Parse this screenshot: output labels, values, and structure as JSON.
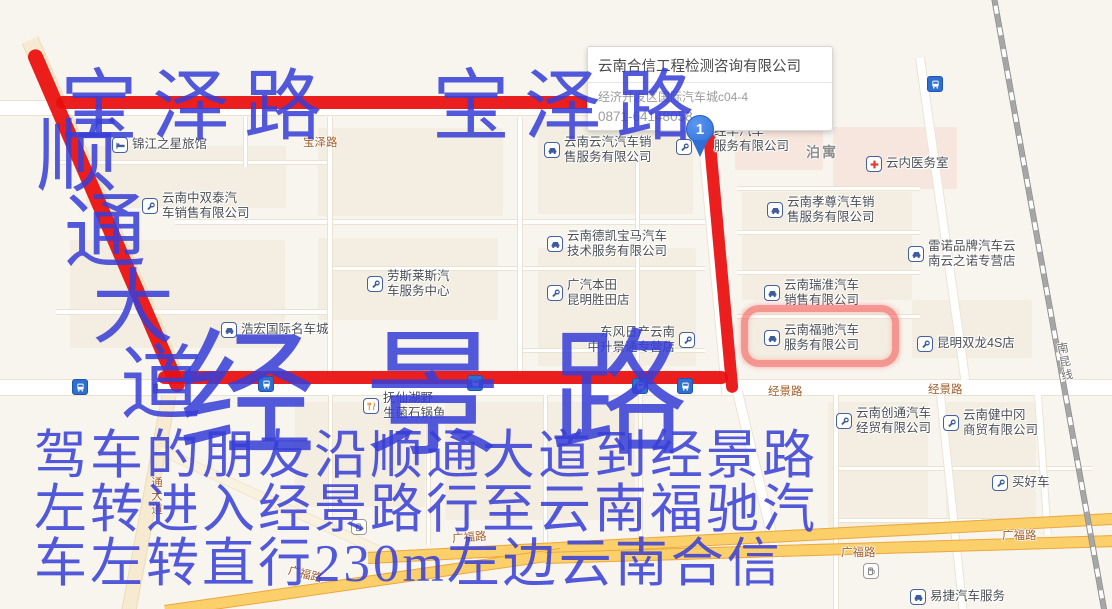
{
  "popup": {
    "title": "云南合信工程检测咨询有限公司",
    "address": "经济开发区国际汽车城c04-4",
    "phone": "0871-64148058"
  },
  "marker": {
    "label": "1"
  },
  "pois": [
    {
      "icon": "hotel",
      "x": 112,
      "y": 137,
      "lines": [
        "锦江之星旅馆"
      ]
    },
    {
      "icon": "wrench",
      "x": 142,
      "y": 198,
      "lines": [
        "云南中双泰汽",
        "车销售有限公司"
      ]
    },
    {
      "icon": "wrench",
      "x": 367,
      "y": 276,
      "lines": [
        "劳斯莱斯汽",
        "车服务中心"
      ]
    },
    {
      "icon": "car",
      "x": 221,
      "y": 322,
      "lines": [
        "浩宏国际名车城"
      ]
    },
    {
      "icon": "car",
      "x": 544,
      "y": 142,
      "lines": [
        "云南云汽汽车销",
        "售服务有限公司"
      ]
    },
    {
      "icon": "car",
      "x": 547,
      "y": 236,
      "lines": [
        "云南德凯宝马汽车",
        "技术服务有限公司"
      ]
    },
    {
      "icon": "wrench",
      "x": 547,
      "y": 285,
      "lines": [
        "广汽本田",
        "昆明胜田店"
      ]
    },
    {
      "icon": "wrench",
      "x": 679,
      "y": 332,
      "side": "right",
      "lines": [
        "东风日产云南",
        "中升景通专营店"
      ]
    },
    {
      "icon": null,
      "x": 714,
      "y": 131,
      "lines": [
        "经华汽车",
        "服务有限公司"
      ]
    },
    {
      "icon": "wrench",
      "x": 676,
      "y": 139,
      "lines": []
    },
    {
      "icon": "cross",
      "x": 866,
      "y": 156,
      "lines": [
        "云内医务室"
      ]
    },
    {
      "icon": "car",
      "x": 767,
      "y": 202,
      "lines": [
        "云南孝尊汽车销",
        "售服务有限公司"
      ]
    },
    {
      "icon": "car",
      "x": 908,
      "y": 246,
      "lines": [
        "雷诺品牌汽车云",
        "南云之诺专营店"
      ]
    },
    {
      "icon": "car",
      "x": 764,
      "y": 285,
      "lines": [
        "云南瑞淮汽车",
        "销售有限公司"
      ]
    },
    {
      "icon": "car",
      "x": 764,
      "y": 330,
      "lines": [
        "云南福驰汽车",
        "服务有限公司"
      ]
    },
    {
      "icon": "wrench",
      "x": 917,
      "y": 336,
      "lines": [
        "昆明双龙4S店"
      ]
    },
    {
      "icon": "restaurant",
      "x": 363,
      "y": 398,
      "lines": [
        "抚仙湖野",
        "生菌石锅鱼"
      ]
    },
    {
      "icon": "wrench",
      "x": 836,
      "y": 413,
      "lines": [
        "云南创通汽车",
        "经贸有限公司"
      ]
    },
    {
      "icon": "wrench",
      "x": 943,
      "y": 415,
      "lines": [
        "云南健中冈",
        "商贸有限公司"
      ]
    },
    {
      "icon": "wrench",
      "x": 992,
      "y": 475,
      "lines": [
        "买好车"
      ]
    },
    {
      "icon": "car",
      "x": 910,
      "y": 589,
      "lines": [
        "易捷汽车服务"
      ]
    }
  ],
  "area_labels": [
    {
      "text": "泊寓",
      "x": 806,
      "y": 142
    }
  ],
  "map_icons": [
    {
      "type": "bus",
      "x": 927,
      "y": 76
    },
    {
      "type": "bus",
      "x": 72,
      "y": 379
    },
    {
      "type": "bus",
      "x": 258,
      "y": 376
    },
    {
      "type": "bus",
      "x": 467,
      "y": 375
    },
    {
      "type": "bus",
      "x": 632,
      "y": 378
    },
    {
      "type": "bus",
      "x": 677,
      "y": 378
    },
    {
      "type": "gas",
      "x": 351,
      "y": 519
    },
    {
      "type": "gas",
      "x": 863,
      "y": 563
    },
    {
      "type": "traffic-light",
      "x": 149,
      "y": 378
    }
  ],
  "road_labels": [
    {
      "text": "宝泽路",
      "x": 303,
      "y": 134
    },
    {
      "text": "经景路",
      "x": 768,
      "y": 383
    },
    {
      "text": "经景路",
      "x": 928,
      "y": 381
    },
    {
      "text": "广福路",
      "x": 288,
      "y": 566,
      "rot": 14
    },
    {
      "text": "广福路",
      "x": 452,
      "y": 529,
      "rot": -4
    },
    {
      "text": "广福路",
      "x": 841,
      "y": 544
    },
    {
      "text": "广福路",
      "x": 1002,
      "y": 527
    },
    {
      "text": "通大道",
      "x": 148,
      "y": 476,
      "vert": true
    },
    {
      "text": "南昆线",
      "x": 1056,
      "y": 342,
      "vert": true,
      "rot": -9,
      "color": "#6b6b6b"
    }
  ],
  "annotations": {
    "color": "rgba(55,62,214,0.86)",
    "texts": [
      {
        "text": "宝泽路",
        "x": 60,
        "y": 68,
        "size": 78,
        "ls": 14
      },
      {
        "text": "宝泽路",
        "x": 432,
        "y": 68,
        "size": 78,
        "ls": 14
      },
      {
        "text": "顺通大道",
        "x": 36,
        "y": 116,
        "size": 82,
        "stair_dx": 28,
        "stair_dy": 76
      },
      {
        "text": "经景路",
        "x": 178,
        "y": 328,
        "size": 138,
        "ls": 48
      },
      {
        "text": "驾车的朋友沿顺通大道到经景路",
        "x": 34,
        "y": 430,
        "size": 53,
        "ls": 3
      },
      {
        "text": "左转进入经景路行至云南福驰汽",
        "x": 34,
        "y": 484,
        "size": 53,
        "ls": 3
      },
      {
        "text": "车左转直行230m左边云南合信",
        "x": 34,
        "y": 538,
        "size": 53,
        "ls": 3
      }
    ]
  },
  "route": {
    "color": "#ea0e0e",
    "segments": [
      {
        "x": 56,
        "y": 102,
        "len": 536,
        "w": 13
      },
      {
        "x": 680,
        "y": 102,
        "len": 60,
        "w": 13
      },
      {
        "x": 32,
        "y": 50,
        "len": 372,
        "w": 15,
        "v": true,
        "ang": -23.4
      },
      {
        "x": 706,
        "y": 100,
        "len": 294,
        "w": 12,
        "v": true,
        "ang": -5.2
      },
      {
        "x": 158,
        "y": 377,
        "len": 570,
        "w": 13
      }
    ],
    "highlight": {
      "x": 741,
      "y": 305,
      "w": 158,
      "h": 62
    }
  }
}
